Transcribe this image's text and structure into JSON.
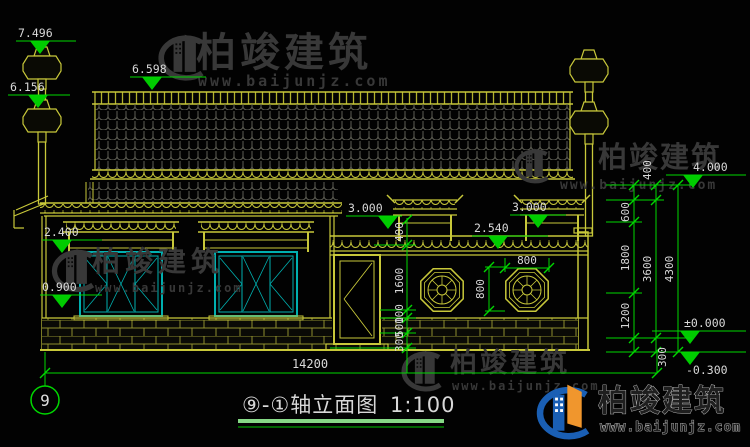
{
  "watermark": {
    "brand": "柏竣建筑",
    "site": "www.baijunjz.com"
  },
  "title": {
    "name": "⑨-①轴立面图",
    "scale": "1:100"
  },
  "axis": {
    "bubble": "9"
  },
  "levels": {
    "finial_top": "7.496",
    "ridge": "6.598",
    "left_ornament": "6.156",
    "window_canopy": "2.400",
    "window_sill": "0.900",
    "gate_left": "3.000",
    "wall_coping": "2.540",
    "gate_right": "3.000",
    "main_eave": "4.000",
    "ground": "±0.000",
    "below_ground": "-0.300"
  },
  "dims": {
    "total_width": "14200",
    "right_chain": [
      "400",
      "600",
      "1800",
      "1200",
      "300"
    ],
    "right_subtotal": "3600",
    "right_total": "4300",
    "mid_chain": [
      "400",
      "1600",
      "100",
      "500",
      "300"
    ],
    "octagon_width": "800",
    "octagon_height": "800"
  },
  "colors": {
    "linework": "#c8c83a",
    "dimension": "#00d800",
    "window_frame": "#00b0b0",
    "watermark_gray": "#383838",
    "logo_blue": "#1a5fb4",
    "logo_orange": "#f0962d"
  }
}
